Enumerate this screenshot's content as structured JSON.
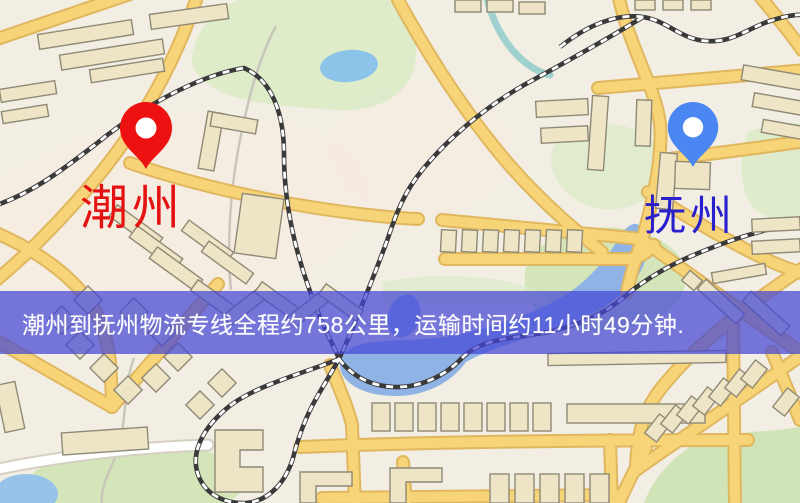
{
  "banner": {
    "text": "潮州到抚州物流专线全程约758公里，运输时间约11小时49分钟."
  },
  "markers": {
    "origin": {
      "label": "潮州",
      "pin_color": "#ee1111",
      "label_color": "#e51212"
    },
    "destination": {
      "label": "抚州",
      "pin_color": "#4b87f2",
      "label_color": "#2a1fcc"
    }
  },
  "map": {
    "colors": {
      "background": "#f2eee3",
      "road_core": "#f7d477",
      "road_casing": "#e0b75f",
      "road_white": "#ffffff",
      "road_white_casing": "#d6d0c2",
      "water": "#8fb3e4",
      "lake": "#8cc3e8",
      "park_green": "#cfe3b4",
      "park_green_pale": "#dcebc8",
      "railway_dark": "#3a3a3a",
      "railway_dash": "#ffffff",
      "building_fill": "#eee4c6",
      "building_stroke": "#8f8a76",
      "banner_overlay": "rgba(68,70,214,0.72)",
      "banner_text": "#ffffff"
    }
  }
}
